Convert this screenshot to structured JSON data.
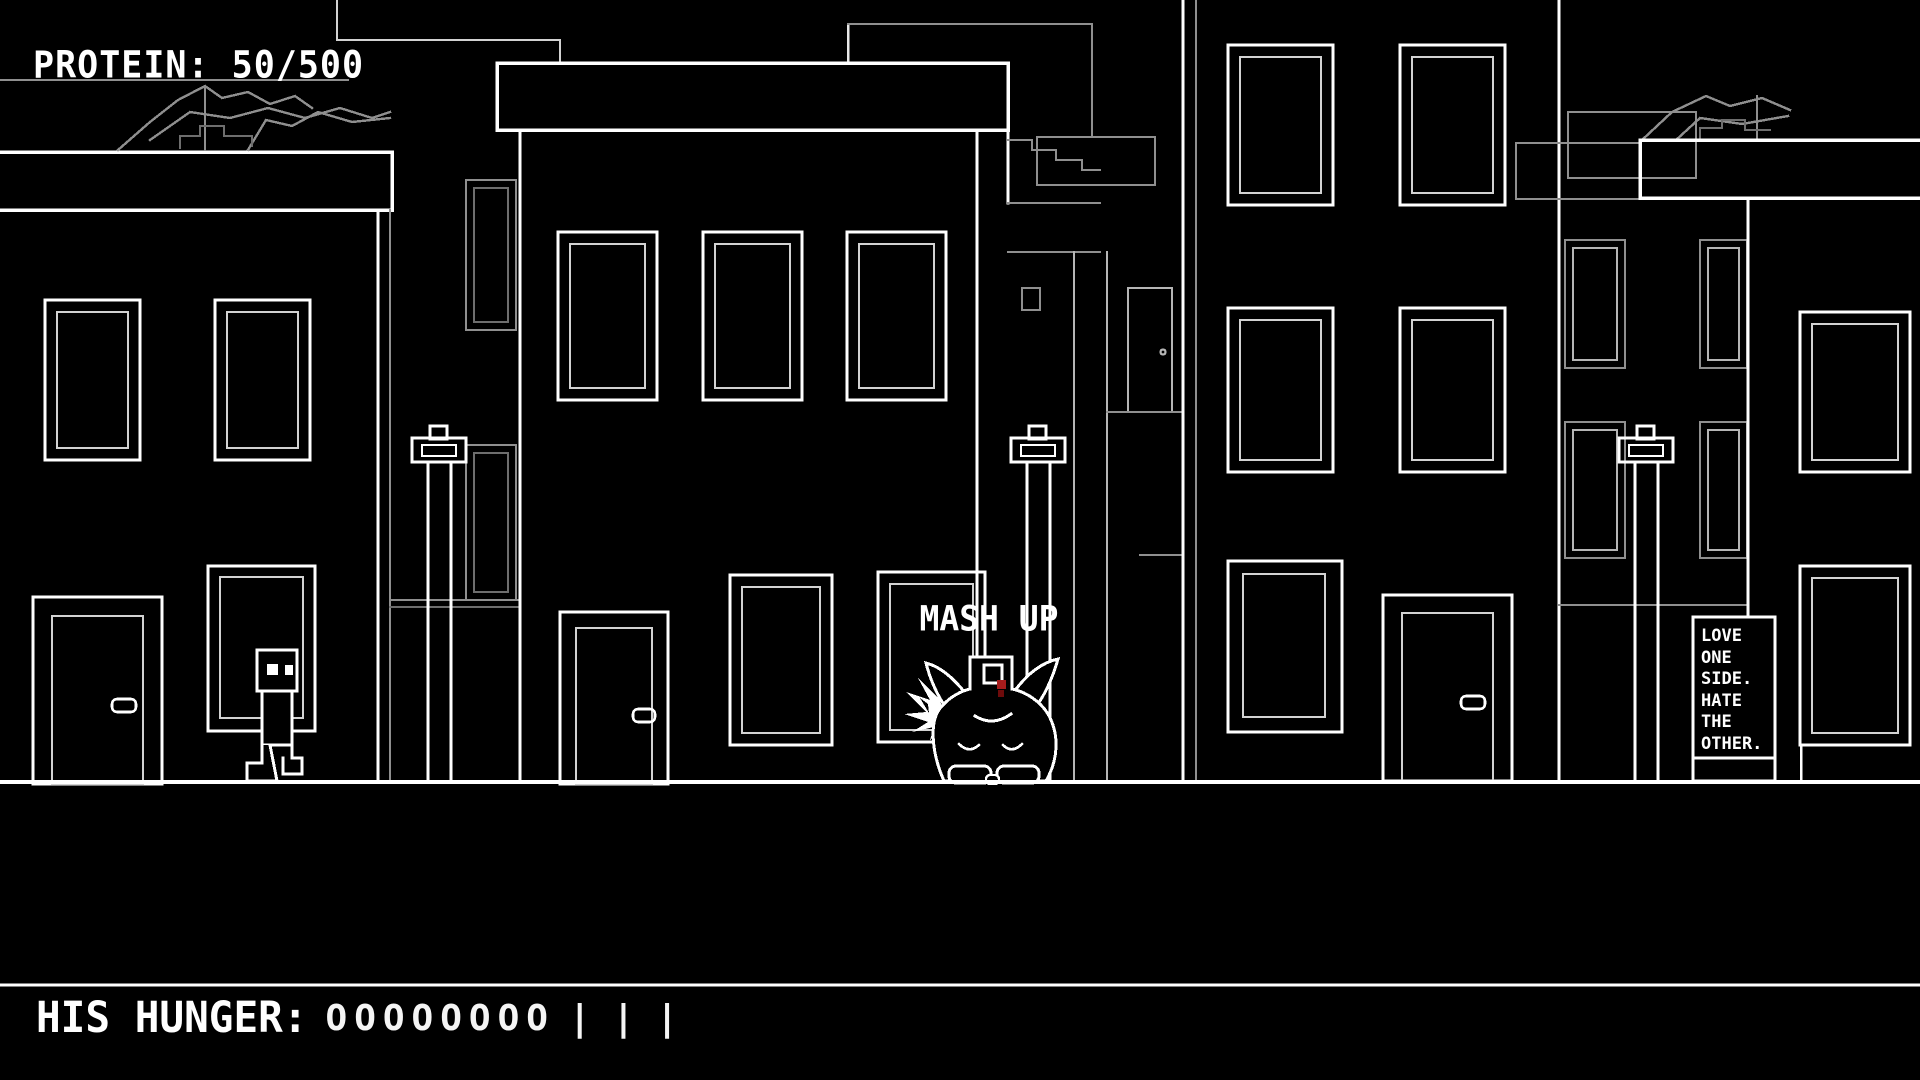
{
  "hud": {
    "protein": {
      "label": "PROTEIN: 50/500",
      "value": 50,
      "max": 500
    },
    "hunger": {
      "label": "HIS HUNGER:",
      "meter_filled": "OOOOOOOO",
      "meter_empty": "|||",
      "filled_slots": 8,
      "empty_slots": 3
    },
    "monster_label": "MASH UP"
  },
  "billboard": {
    "lines": [
      "LOVE",
      "ONE",
      "SIDE.",
      "HATE",
      "THE",
      "OTHER."
    ]
  },
  "colors": {
    "background": "#000000",
    "foreground_line": "#ffffff",
    "inner_frame_line": "#d2d2d2",
    "background_line": "#8f8f8f",
    "background_line_light": "#b5b5b5",
    "monster_eye_red": "#a51c1c",
    "monster_eye_red_dark": "#6e0b0b"
  },
  "icons": {
    "lamppost": "street-lamp",
    "player": "box-headed-robot",
    "monster": "round-monster"
  }
}
